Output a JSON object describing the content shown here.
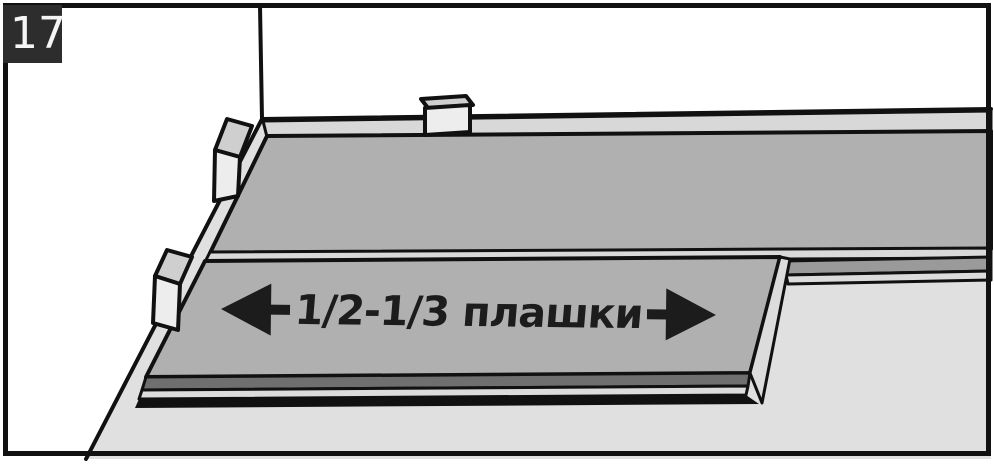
{
  "figure": {
    "step_number": "17",
    "annotation_label": "1/2-1/3 плашки",
    "icons": {
      "left_arrow": "◀",
      "right_arrow": "▶"
    }
  },
  "colors": {
    "frame": "#111111",
    "outline": "#111111",
    "wall": "#ffffff",
    "floor": "#e0e0e0",
    "plank_top": "#b0b0b0",
    "plank_back_strip": "#d8d8d8",
    "joint_strip": "#d9d9d9",
    "tongue_dark": "#9a9a9a",
    "edge_dark": "#6f6f6f",
    "edge_light": "#dcdcdc",
    "spacer_top": "#cfcfcf",
    "spacer_front": "#ededed",
    "badge_bg": "#2d2d2d",
    "badge_text": "#f5f5f5",
    "annotation_text": "#1c1c1c"
  }
}
